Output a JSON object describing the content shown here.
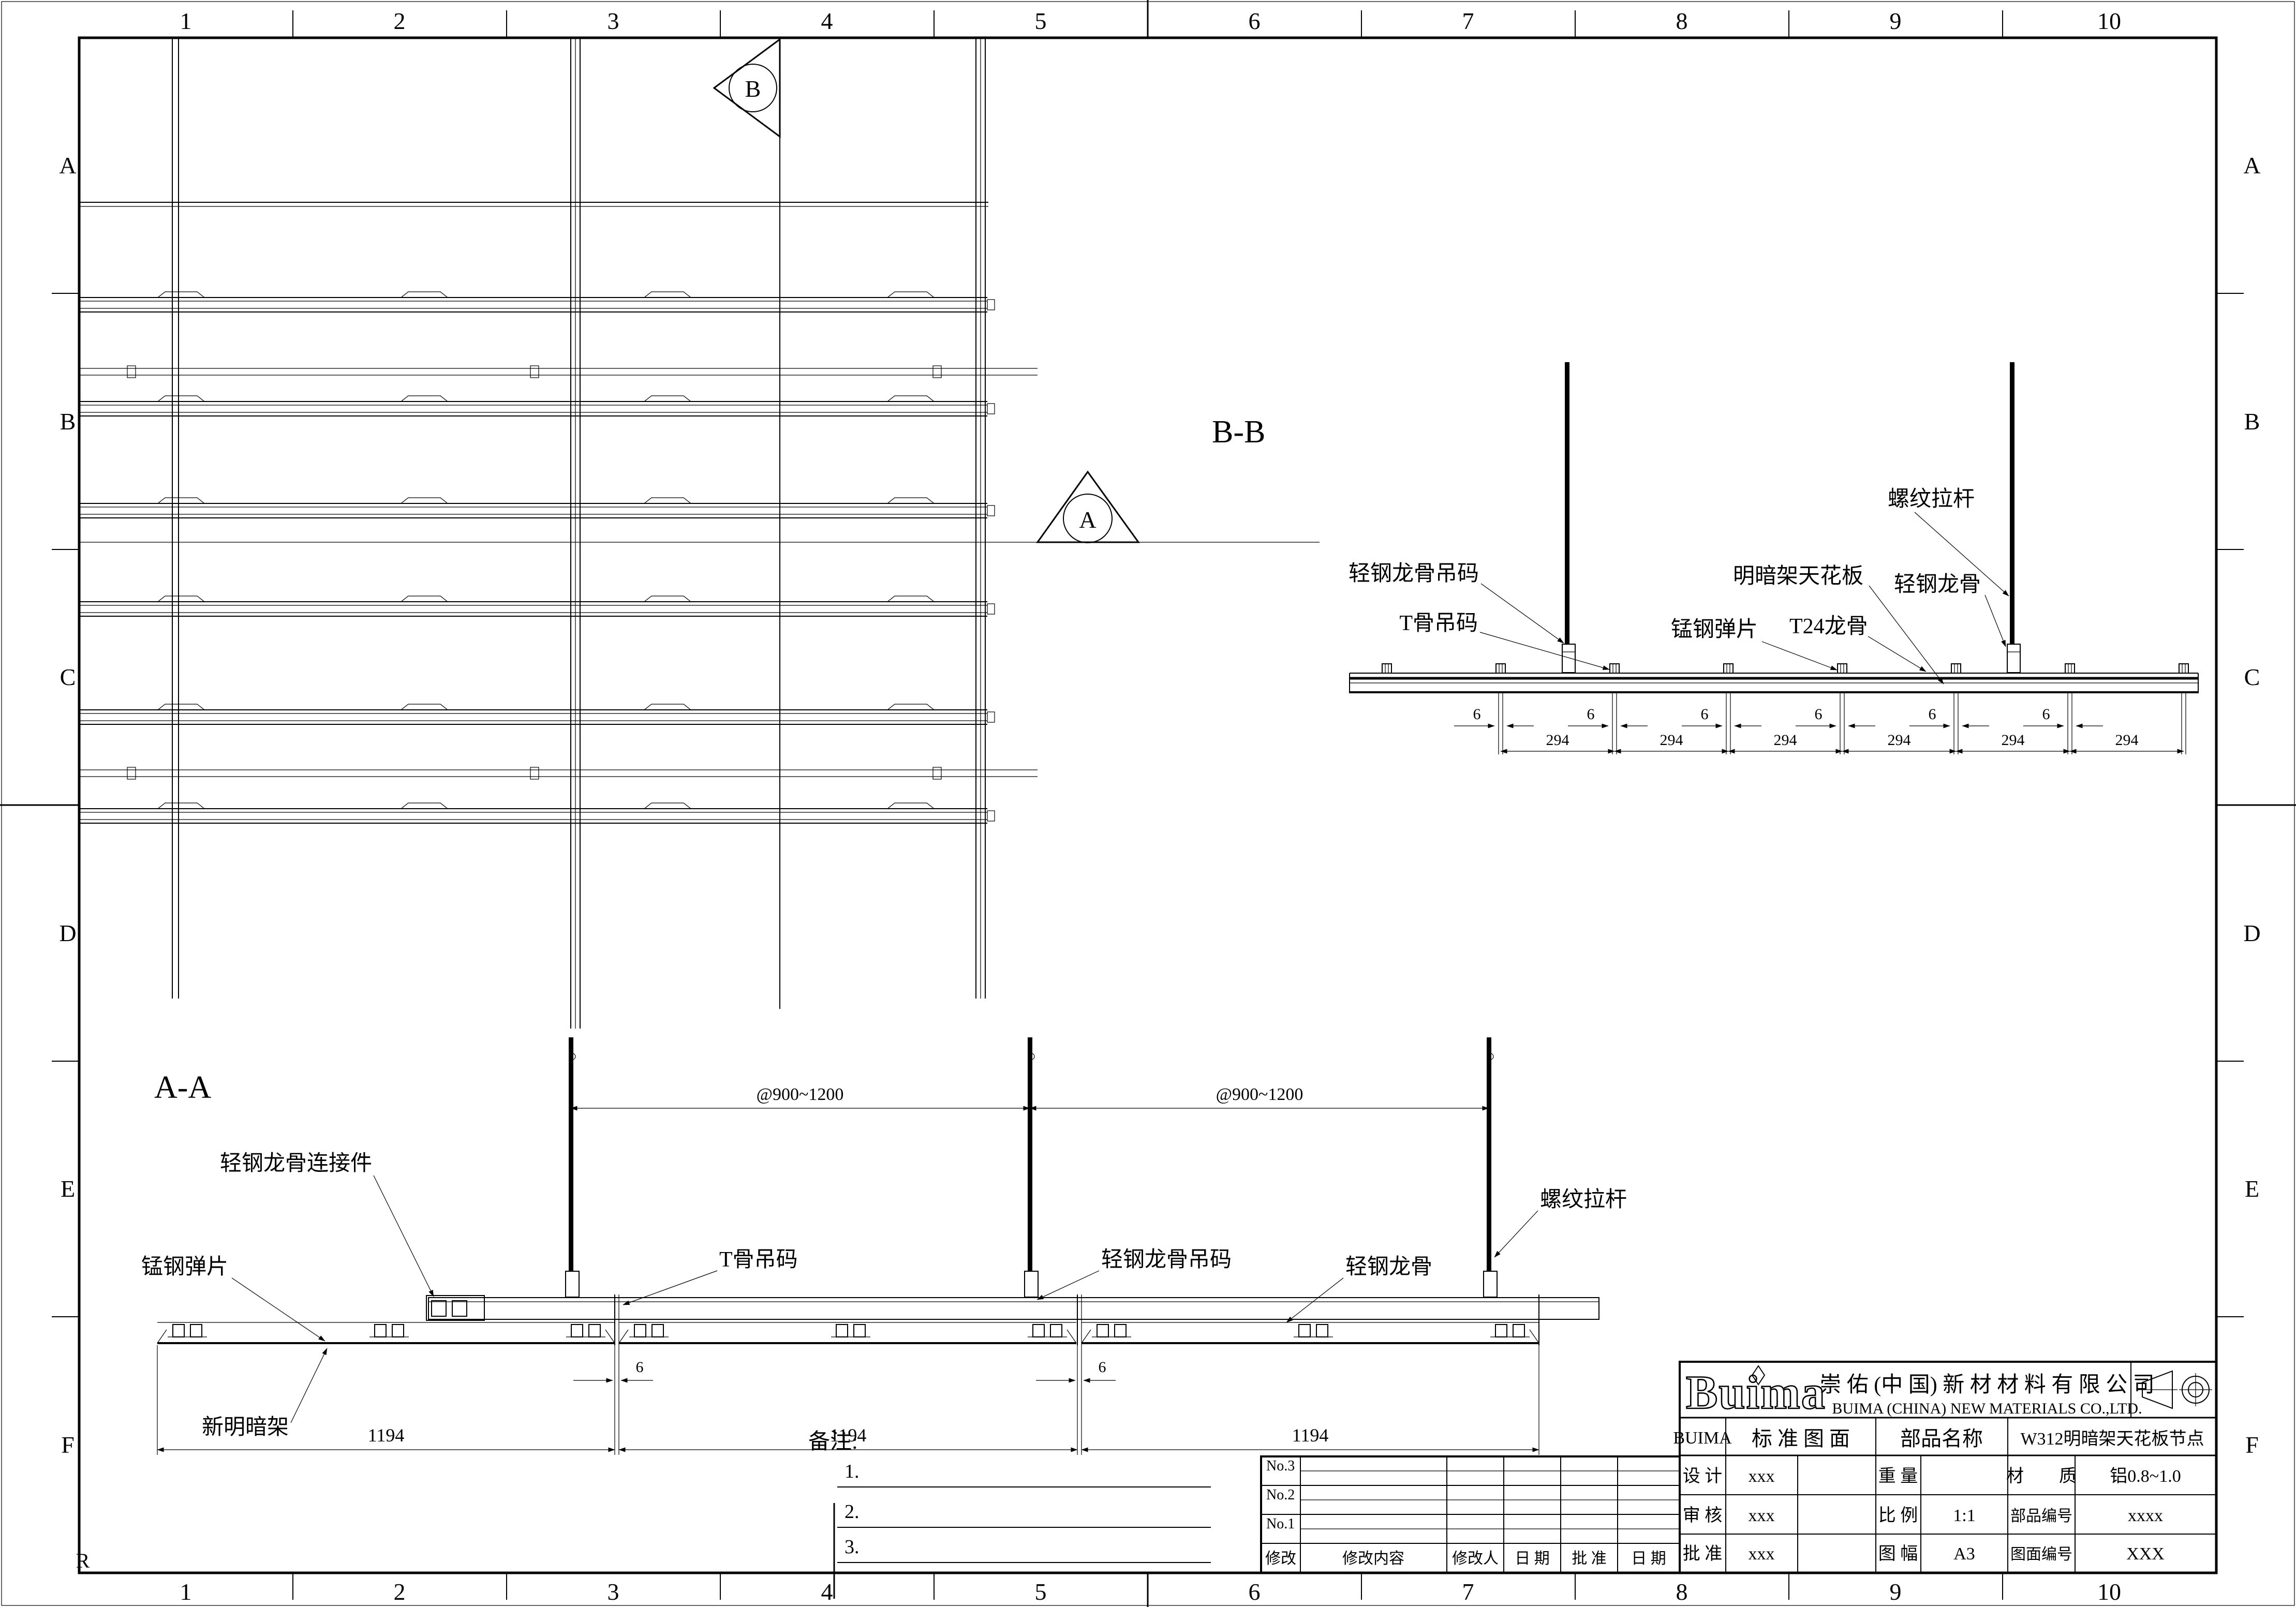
{
  "border": {
    "cols": [
      "1",
      "2",
      "3",
      "4",
      "5",
      "6",
      "7",
      "8",
      "9",
      "10"
    ],
    "rows": [
      "A",
      "B",
      "C",
      "D",
      "E",
      "F"
    ],
    "corner_mark": "R"
  },
  "plan": {
    "marker_a": "A",
    "marker_b": "B"
  },
  "bb": {
    "title": "B-B",
    "dim6": "6",
    "dim294": "294",
    "labels": {
      "hanger": "轻钢龙骨吊码",
      "t_hanger": "T骨吊码",
      "spring": "锰钢弹片",
      "panel": "明暗架天花板",
      "t24": "T24龙骨",
      "rod": "螺纹拉杆",
      "runner": "轻钢龙骨"
    }
  },
  "aa": {
    "title": "A-A",
    "dim6": "6",
    "dim1194": "1194",
    "spacing": "@900~1200",
    "labels": {
      "connector": "轻钢龙骨连接件",
      "spring": "锰钢弹片",
      "t_hanger": "T骨吊码",
      "hanger": "轻钢龙骨吊码",
      "runner": "轻钢龙骨",
      "rod": "螺纹拉杆",
      "panel": "新明暗架"
    }
  },
  "notes": {
    "title": "备注:",
    "item1": "1.",
    "item2": "2.",
    "item3": "3."
  },
  "revision": {
    "rows": [
      "No.3",
      "No.2",
      "No.1"
    ],
    "headers": [
      "修改",
      "修改内容",
      "修改人",
      "日 期",
      "批 准",
      "日 期"
    ]
  },
  "titleblock": {
    "logo": "Buima",
    "brand": "BUIMA",
    "company_cn": "崇 佑 (中 国) 新 材 材 料 有 限 公 司",
    "company_en": "BUIMA (CHINA) NEW MATERIALS CO.,LTD.",
    "standard": "标 准 图 面",
    "part_name_label": "部品名称",
    "part_name": "W312明暗架天花板节点",
    "design_label": "设 计",
    "design_value": "xxx",
    "weight_label": "重 量",
    "weight_value": "",
    "material_label": "材　　质",
    "material_value": "铝0.8~1.0",
    "check_label": "审 核",
    "check_value": "xxx",
    "scale_label": "比 例",
    "scale_value": "1:1",
    "part_no_label": "部品编号",
    "part_no_value": "xxxx",
    "approve_label": "批 准",
    "approve_value": "xxx",
    "sheet_label": "图 幅",
    "sheet_value": "A3",
    "drawing_no_label": "图面编号",
    "drawing_no_value": "XXX"
  }
}
